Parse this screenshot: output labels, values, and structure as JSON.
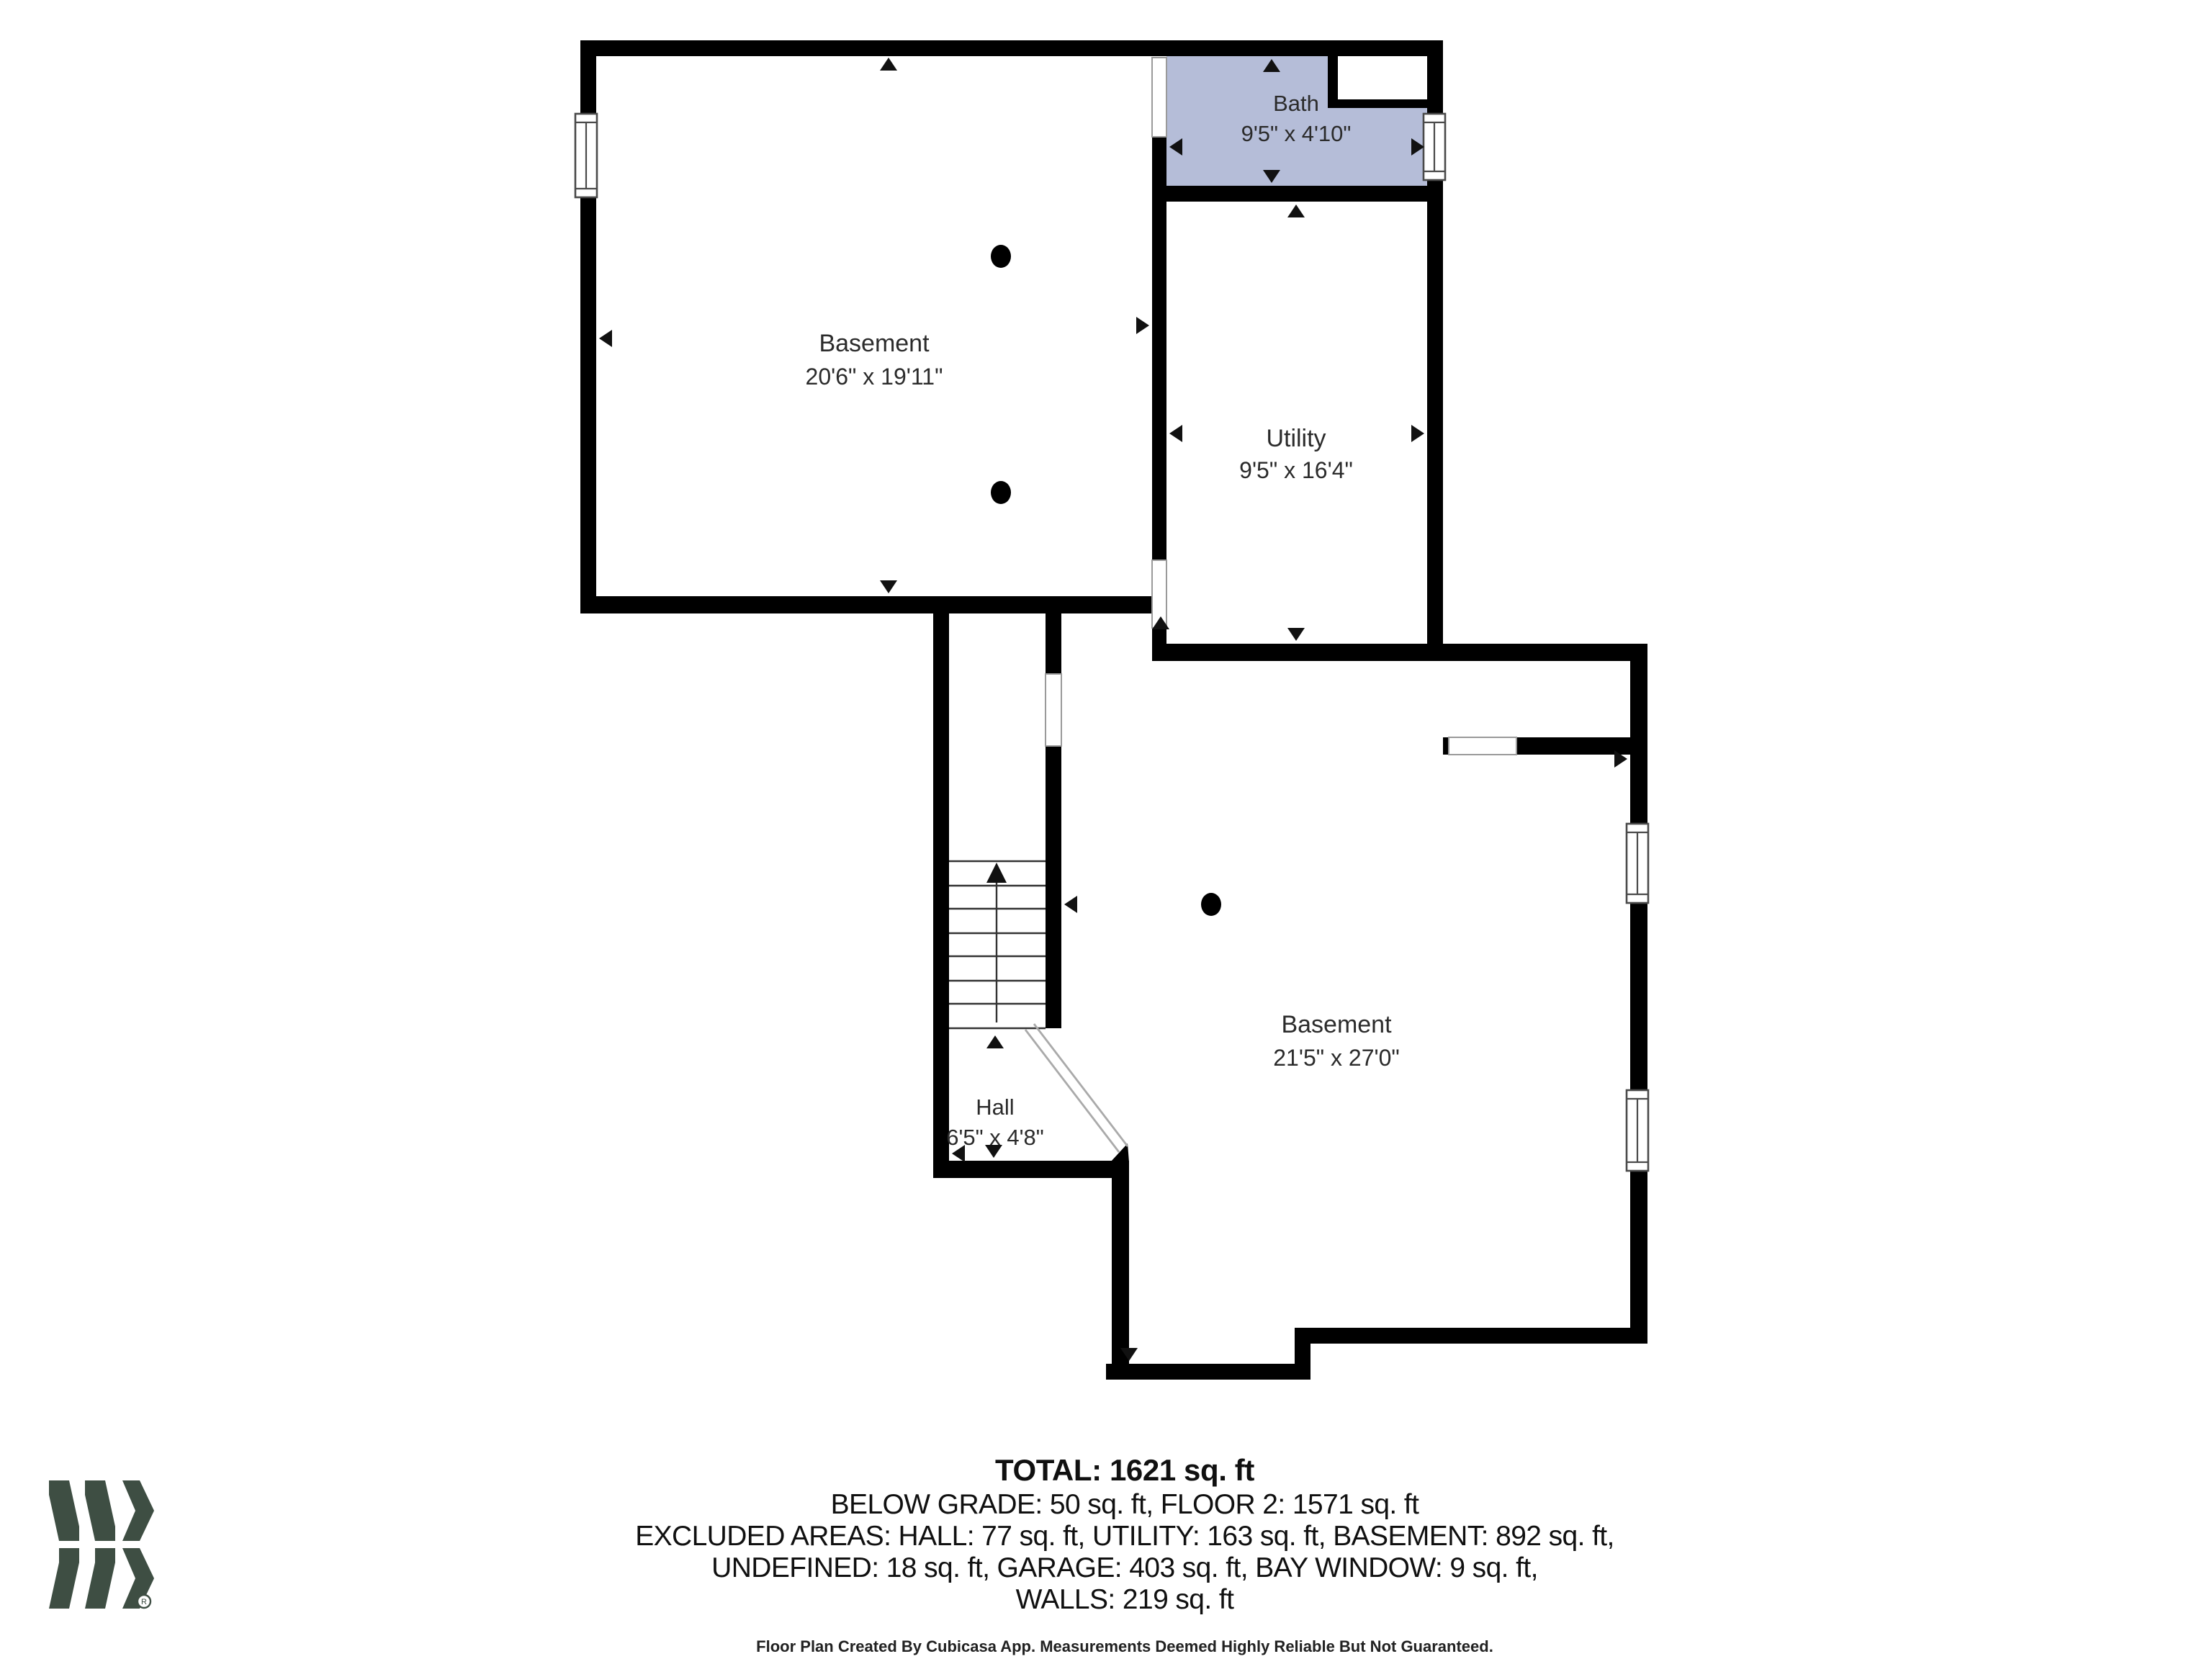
{
  "floorplan": {
    "highlight_color": "#b5bdd8",
    "wall_color": "#000000",
    "rooms": [
      {
        "id": "basement-upper",
        "name": "Basement",
        "dims": "20'6\" x 19'11\""
      },
      {
        "id": "bath",
        "name": "Bath",
        "dims": "9'5\" x 4'10\""
      },
      {
        "id": "utility",
        "name": "Utility",
        "dims": "9'5\" x 16'4\""
      },
      {
        "id": "hall",
        "name": "Hall",
        "dims": "6'5\" x 4'8\""
      },
      {
        "id": "basement-lower",
        "name": "Basement",
        "dims": "21'5\" x 27'0\""
      }
    ]
  },
  "summary": {
    "total": "TOTAL: 1621 sq. ft",
    "line1": "BELOW GRADE: 50 sq. ft, FLOOR 2: 1571 sq. ft",
    "line2": "EXCLUDED AREAS: HALL: 77 sq. ft, UTILITY: 163 sq. ft, BASEMENT: 892 sq. ft,",
    "line3": "UNDEFINED: 18 sq. ft, GARAGE: 403 sq. ft, BAY WINDOW: 9 sq. ft,",
    "line4": "WALLS: 219 sq. ft"
  },
  "footer": {
    "disclaimer": "Floor Plan Created By Cubicasa App. Measurements Deemed Highly Reliable But Not Guaranteed."
  },
  "logo": {
    "color": "#3e4e43",
    "registered_mark": "R"
  }
}
